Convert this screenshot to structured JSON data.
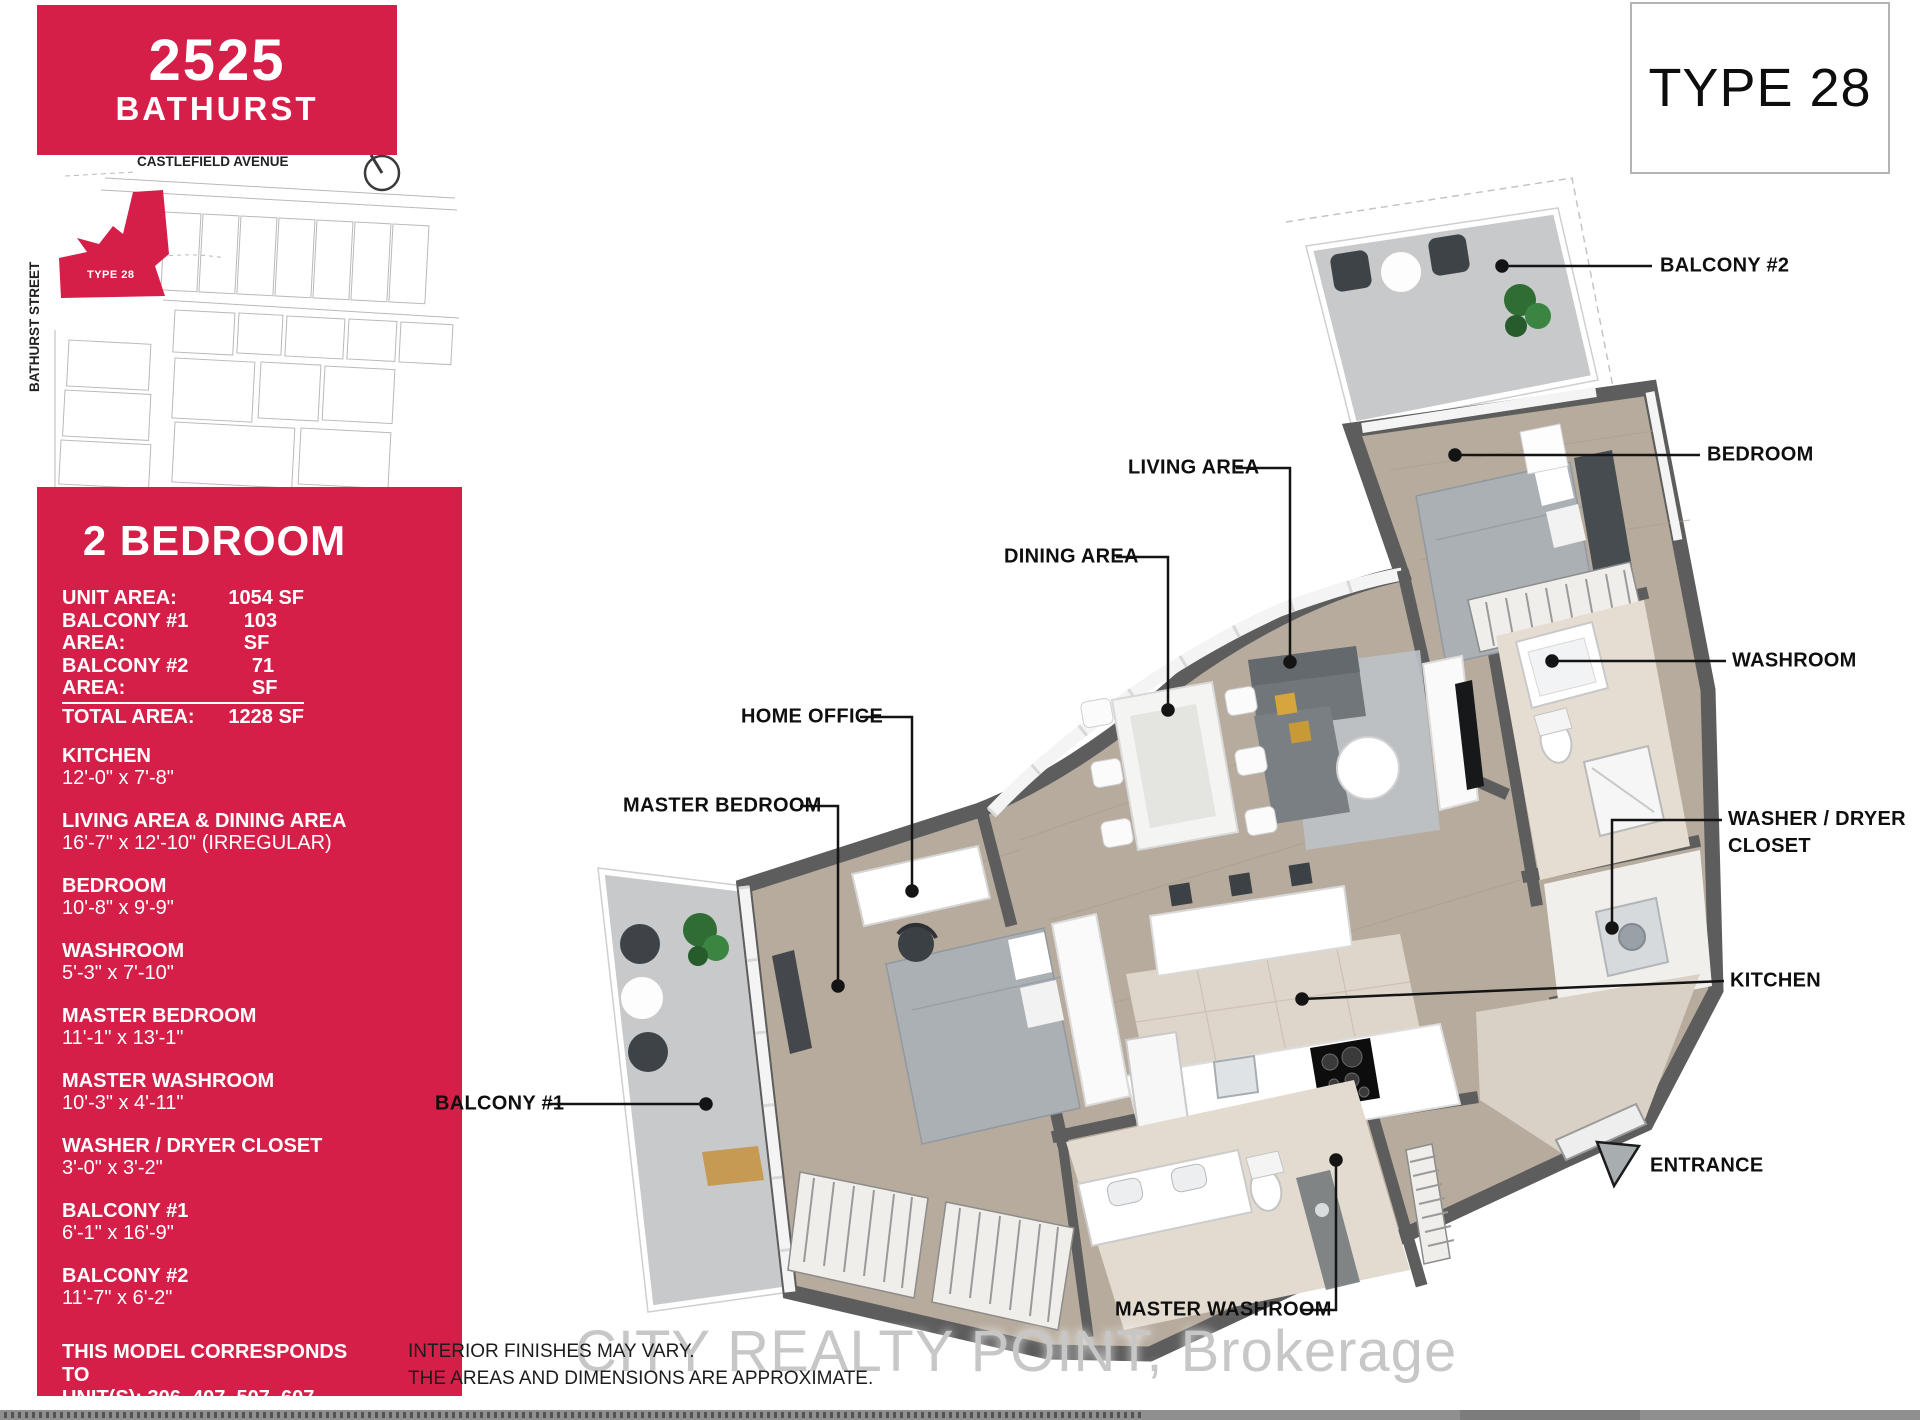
{
  "colors": {
    "brand_red": "#d51f48",
    "wall_gray": "#5d5d5d",
    "floor_tan": "#b6ab9d",
    "tile_beige": "#ded6cb",
    "concrete_gray": "#c7c9cb",
    "accent_yellow": "#d6a53e",
    "watermark_gray": "#c7c7c7"
  },
  "header": {
    "address_number": "2525",
    "address_street": "BATHURST"
  },
  "type_badge": {
    "label": "TYPE 28"
  },
  "site_map": {
    "street_top": "CASTLEFIELD AVENUE",
    "street_left": "BATHURST STREET",
    "highlight_label": "TYPE 28",
    "compass_icon": "north-arrow-clock-icon"
  },
  "sidebar": {
    "title": "2 BEDROOM",
    "areas": [
      {
        "label": "UNIT AREA:",
        "value": "1054 SF"
      },
      {
        "label": "BALCONY #1 AREA:",
        "value": "103 SF"
      },
      {
        "label": "BALCONY #2 AREA:",
        "value": "71 SF"
      },
      {
        "label": "TOTAL AREA:",
        "value": "1228 SF"
      }
    ],
    "rooms": [
      {
        "name": "KITCHEN",
        "dims": "12'-0\" x 7'-8\""
      },
      {
        "name": "LIVING AREA & DINING AREA",
        "dims": "16'-7\" x 12'-10\" (IRREGULAR)"
      },
      {
        "name": "BEDROOM",
        "dims": "10'-8\" x 9'-9\""
      },
      {
        "name": "WASHROOM",
        "dims": "5'-3\" x 7'-10\""
      },
      {
        "name": "MASTER BEDROOM",
        "dims": "11'-1\" x 13'-1\""
      },
      {
        "name": "MASTER WASHROOM",
        "dims": "10'-3\" x 4'-11\""
      },
      {
        "name": "WASHER / DRYER CLOSET",
        "dims": "3'-0\" x 3'-2\""
      },
      {
        "name": "BALCONY #1",
        "dims": "6'-1\" x 16'-9\""
      },
      {
        "name": "BALCONY #2",
        "dims": "11'-7\" x 6'-2\""
      }
    ],
    "footer_line1": "THIS MODEL CORRESPONDS TO",
    "footer_line2": "UNIT(S): 306, 407, 507, 607, 707, 807."
  },
  "floor_plan": {
    "labels": {
      "balcony2": "BALCONY #2",
      "bedroom": "BEDROOM",
      "living_area": "LIVING AREA",
      "dining_area": "DINING AREA",
      "washroom": "WASHROOM",
      "washer_dryer": "WASHER / DRYER CLOSET",
      "kitchen": "KITCHEN",
      "home_office": "HOME OFFICE",
      "master_bedroom": "MASTER BEDROOM",
      "balcony1": "BALCONY #1",
      "entrance": "ENTRANCE",
      "master_washroom": "MASTER WASHROOM"
    }
  },
  "footer": {
    "watermark": "CITY REALTY POINT, Brokerage",
    "disclaimer_line1": "INTERIOR FINISHES MAY VARY.",
    "disclaimer_line2": "THE AREAS AND DIMENSIONS ARE APPROXIMATE."
  }
}
